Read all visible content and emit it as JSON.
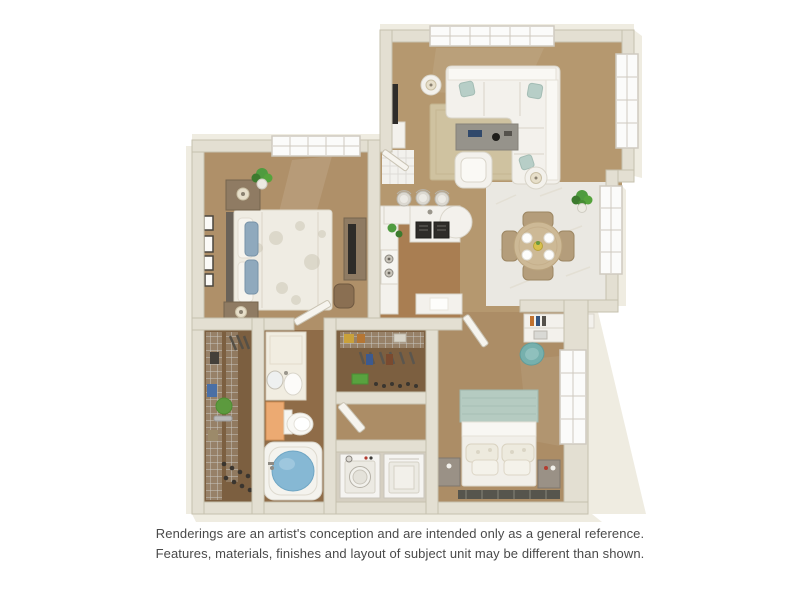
{
  "page": {
    "background": "#ffffff"
  },
  "disclaimer": {
    "line1": "Renderings are an artist's conception and are intended only as a general reference.",
    "line2": "Features, materials, finishes and layout of subject unit may be different than shown."
  },
  "palette": {
    "wall": "#e3dfd2",
    "wall_edge": "#c6c0ae",
    "wall_face": "#efece1",
    "carpet": "#b5986f",
    "carpet_master": "#af9069",
    "carpet_b2": "#ac8d66",
    "wood": "#a97e52",
    "tile": "#eae8e2",
    "tile_line": "#d8d5cc",
    "entry_tile": "#f2f1ed",
    "closet_floor": "#7c5f40",
    "bath_floor": "#8f6c48",
    "laundry_floor": "#d5cfc1",
    "white_furn": "#f3f1ec",
    "furn_edge": "#d9d5ca",
    "rug": "#cfc2a0",
    "rug_edge": "#c2b28c",
    "sofa_pillow": "#b7cec7",
    "dark": "#2e2c29",
    "table_gray": "#96938b",
    "wood_furn": "#8f7b63",
    "headboard_dark": "#6a6258",
    "bed_blue": "#8fa9bd",
    "b2_headboard": "#b5cbc1",
    "b2_rug": "#56554d",
    "teal_chair": "#76b0ad",
    "water": "#86b8d4",
    "orange_cab": "#ecaa72",
    "plant": "#4f9b3f",
    "plant_dark": "#3c7a2e",
    "wire": "#c9c6c0",
    "appliance": "#f5f4f1",
    "accent_red": "#b33c30",
    "book_orange": "#c0722f",
    "book_blue": "#35557f",
    "window": "#fbfbfa",
    "window_frame": "#cfcac0",
    "dining_table": "#cdb996",
    "dining_chair": "#b49d7b",
    "text": "#4a4a4a"
  },
  "floor_plan": {
    "type": "3d-rendering-top-down",
    "rooms": [
      {
        "id": "living-room",
        "furniture": [
          "sectional-sofa",
          "teal-accent-pillows",
          "coffee-table",
          "area-rug",
          "armchair",
          "side-table-lamp-left",
          "side-table-lamp-right",
          "tv-console"
        ]
      },
      {
        "id": "kitchen",
        "furniture": [
          "u-shaped-counter",
          "breakfast-bar",
          "bar-stools-x3",
          "sink",
          "dish-racks-x2",
          "stove",
          "counter-plants",
          "peninsula-counter"
        ]
      },
      {
        "id": "dining-area",
        "furniture": [
          "round-dining-table",
          "dining-chairs-x4",
          "place-settings-x4",
          "centerpiece",
          "potted-plant"
        ]
      },
      {
        "id": "master-bedroom",
        "furniture": [
          "bed-floral-duvet",
          "blue-pillows",
          "nightstands-x2",
          "table-lamps-x2",
          "potted-plant",
          "wall-frames-x4",
          "dresser-with-tv",
          "accent-chair"
        ]
      },
      {
        "id": "walk-in-closet",
        "furniture": [
          "wire-shelving",
          "hanging-clothes",
          "shoe-rows",
          "green-ottoman",
          "tray"
        ]
      },
      {
        "id": "bathroom",
        "furniture": [
          "vanity-cabinet",
          "round-mirror",
          "sink",
          "orange-cabinet",
          "toilet",
          "bathtub-with-water"
        ]
      },
      {
        "id": "second-closet",
        "furniture": [
          "wire-shelving",
          "hanging-clothes",
          "storage-boxes",
          "shoe-row"
        ]
      },
      {
        "id": "laundry-closet",
        "furniture": [
          "washer",
          "dryer"
        ]
      },
      {
        "id": "second-bedroom",
        "furniture": [
          "bed-teal-headboard",
          "pillow-rows",
          "nightstands-x2",
          "desk-shelf-with-books",
          "desk",
          "laptop",
          "teal-desk-chair",
          "dark-rug"
        ]
      },
      {
        "id": "entry",
        "furniture": [
          "tile-floor",
          "front-door"
        ]
      }
    ]
  }
}
